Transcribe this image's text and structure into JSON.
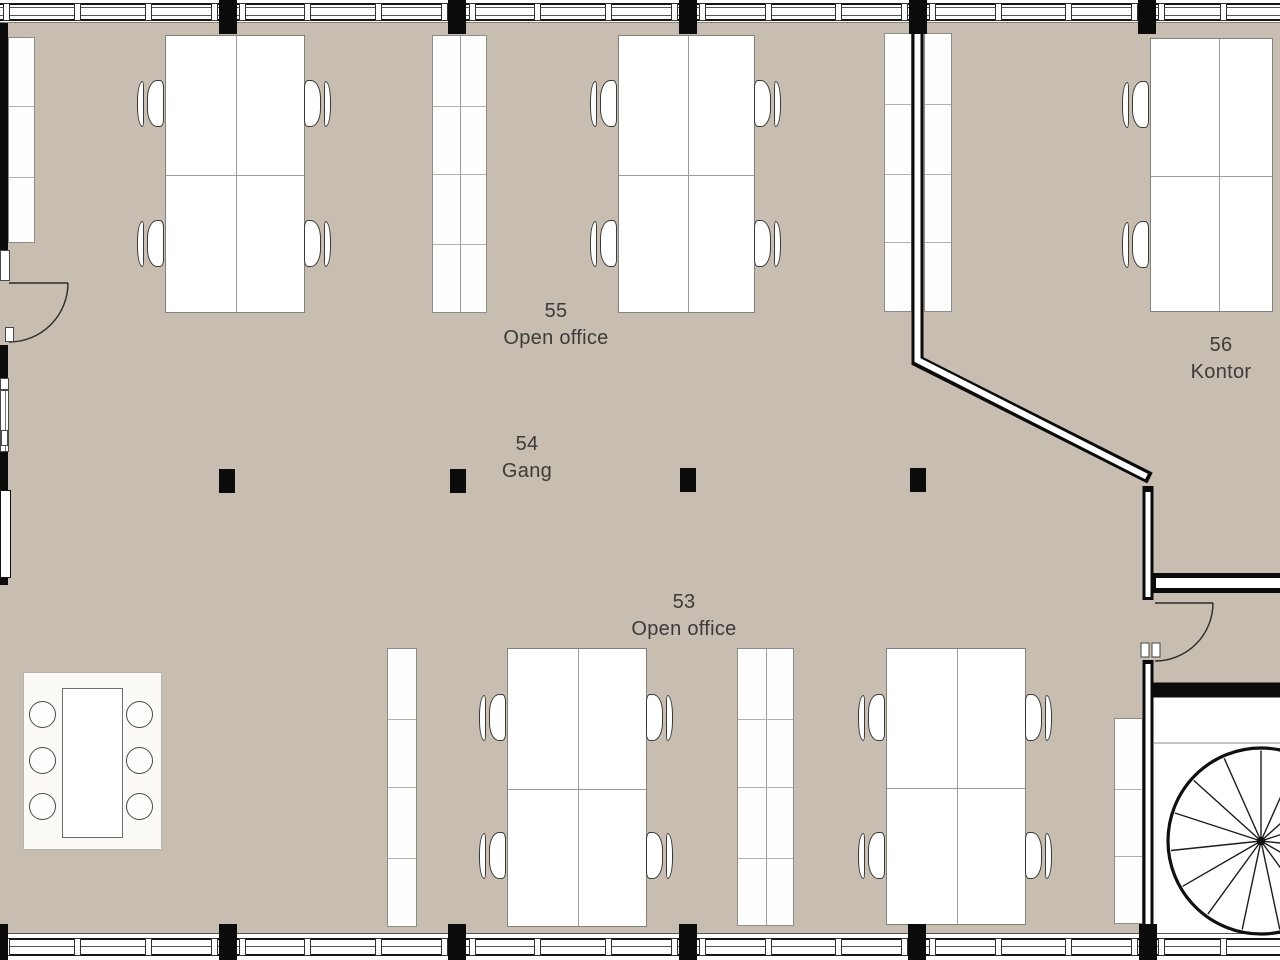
{
  "title": "Office floor plan",
  "rooms": [
    {
      "number": "55",
      "name": "Open office"
    },
    {
      "number": "54",
      "name": "Gang"
    },
    {
      "number": "53",
      "name": "Open office"
    },
    {
      "number": "56",
      "name": "Kontor"
    }
  ],
  "colors": {
    "floor": "#c7beb1",
    "wall": "#0b0b0b",
    "furniture": "#ffffff",
    "text": "#3b3b39"
  }
}
